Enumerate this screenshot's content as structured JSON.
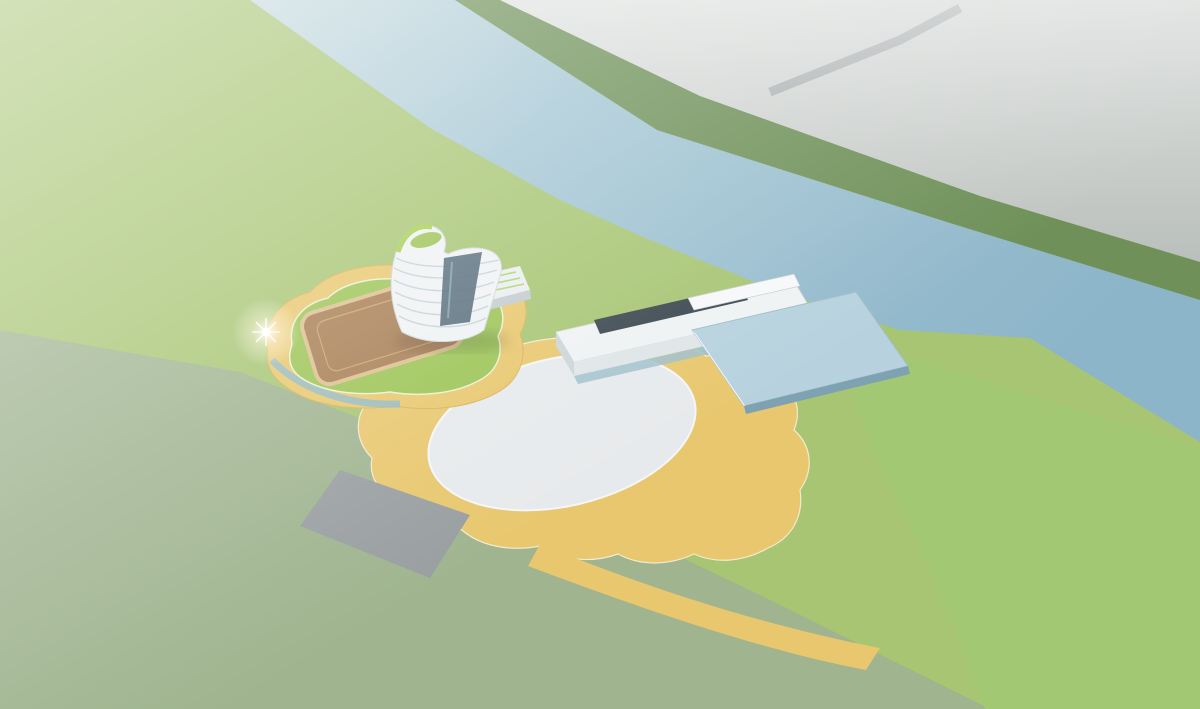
{
  "scene": {
    "title": "Aerial architectural rendering of a riverfront sports and culture campus",
    "description": "Bird's-eye rendering: a curved white campus with green roofs and an oval plaza sits on the near bank of a river; a cable-stayed bridge crosses to a hazy city of gray massing blocks; dragon boats and rowing shells dot the water; a flock of white birds flies over the far bank.",
    "features": [
      "river rowing course",
      "cable-stayed bridge",
      "riverfront running track",
      "gear-shaped dock pier",
      "dragon boats",
      "rowing shells",
      "flock of birds",
      "landmark tower",
      "gym podium with rooftop court",
      "slab building with solar roof",
      "glass hall",
      "curved school complex with green roofs",
      "central oval plaza",
      "sunken ring courtyards",
      "entrance pavilions",
      "red futsal courts",
      "tree-lined boulevard",
      "parking groves",
      "gray residential massing blocks",
      "morning haze and fog"
    ]
  },
  "palette": {
    "water": "#9cc0d2",
    "campusGrass": "#a7c573",
    "fieldGrass": "#a3c873",
    "residentialGround": "#9fb48f",
    "cityGround": "#b6bcb8",
    "farBankGreen": "#6f9159",
    "treeDark": "#4f7a43",
    "treeMid": "#639551",
    "treeBright": "#6fa757",
    "cityBlock": "#a3abb1",
    "cityBlockTop": "#ccd2d5",
    "residentialBlock": "#9aa1a6",
    "road": "#70757a",
    "bridgeDeck": "#686d71",
    "trackRed": "#c96a66",
    "courtRed": "#ce6f65",
    "deckYellow": "#e8c76e",
    "boardwalkTan": "#d9bc82",
    "roofGreen": "#9cc455",
    "roofGreenDark": "#83ac45",
    "roofBrown": "#a87e54",
    "buildingWhite": "#eff2f3",
    "glassBlue": "#b7d2de",
    "glassDark": "#4d6675",
    "plazaWhite": "#e7eaec",
    "plazaLawn": "#b3d26a",
    "birdWhite": "#fcfeff",
    "boatGreen": "#3c6148",
    "accentRed": "#b5453c",
    "fog": "#ffffff"
  },
  "counts": {
    "birds": 46,
    "cityBlocks": 72,
    "dragonBoats": 8,
    "rowingShells": 10,
    "plazaPeople": 150,
    "promenadePeople": 55,
    "deckPeople": 85,
    "terracePeople": 25
  }
}
